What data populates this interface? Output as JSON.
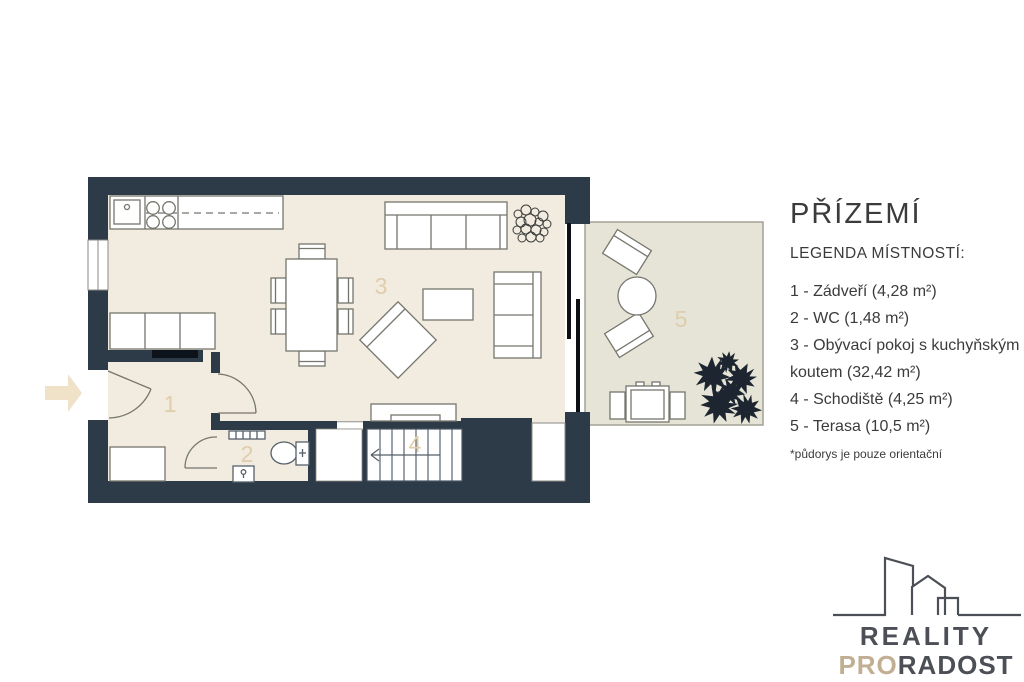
{
  "title": "PŘÍZEMÍ",
  "legend": {
    "heading": "LEGENDA MÍSTNOSTÍ:",
    "items": [
      {
        "label": "1 - Zádveří (4,28 m²)"
      },
      {
        "label": "2 - WC (1,48 m²)"
      },
      {
        "label": "3 - Obývací pokoj s kuchyňským koutem (32,42 m²)"
      },
      {
        "label": "4 - Schodiště (4,25 m²)"
      },
      {
        "label": "5 - Terasa (10,5 m²)"
      }
    ],
    "footnote": "*půdorys je pouze orientační"
  },
  "plan": {
    "room_numbers": {
      "hall": "1",
      "wc": "2",
      "living": "3",
      "stairs": "4",
      "terrace": "5"
    }
  },
  "logo": {
    "line1": "REALITY",
    "line2_accent": "PRO",
    "line2_rest": "RADOST"
  },
  "colors": {
    "wall": "#2d3a47",
    "floor": "#f2ece0",
    "terrace": "#e5e4d6",
    "room_number": "#dfcdab",
    "logo_dark": "#4c5056",
    "logo_accent": "#c2ae92",
    "entry_arrow": "#f0e2c9"
  }
}
